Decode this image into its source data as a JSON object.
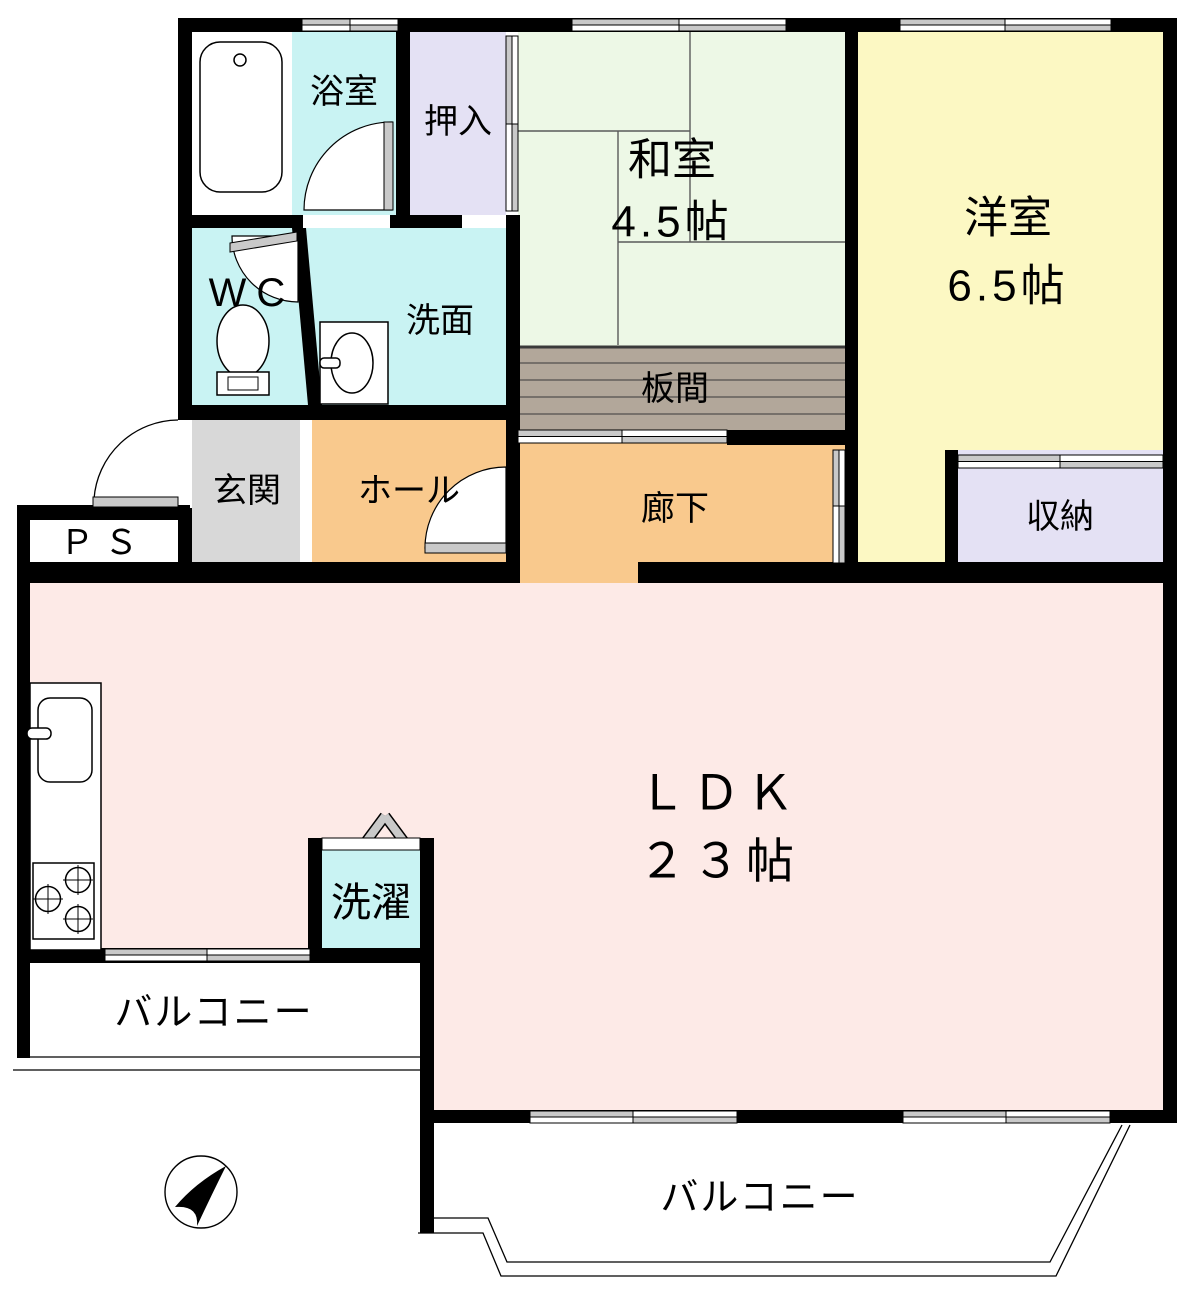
{
  "plan": {
    "type": "apartment-floor-plan",
    "rooms": {
      "bath": {
        "label": "浴室"
      },
      "oshiire": {
        "label": "押入"
      },
      "washitsu": {
        "label": "和室",
        "size": "4.5帖"
      },
      "youshitsu": {
        "label": "洋室",
        "size": "6.5帖"
      },
      "wc": {
        "label": "WC"
      },
      "senmen": {
        "label": "洗面"
      },
      "itama": {
        "label": "板間"
      },
      "genkan": {
        "label": "玄関"
      },
      "hall": {
        "label": "ホール"
      },
      "rouka": {
        "label": "廊下"
      },
      "shuno": {
        "label": "収納"
      },
      "ps": {
        "label": "ＰＳ"
      },
      "ldk": {
        "label": "ＬＤＫ",
        "size": "２３帖"
      },
      "sentaku": {
        "label": "洗濯"
      },
      "balcony_west": {
        "label": "バルコニー"
      },
      "balcony_south": {
        "label": "バルコニー"
      }
    },
    "colors": {
      "wall": "#000000",
      "wet_cyan": "#c9f3f3",
      "closet_lavender": "#e4e1f4",
      "tatami_green": "#edf8e6",
      "western_yellow": "#fcf8c3",
      "entry_gray": "#d8d8d8",
      "hall_orange": "#f9c98d",
      "ldk_pink": "#fdeae7",
      "itama_tan": "#b2a79a",
      "window_gray": "#c9c9c9",
      "background": "#ffffff"
    },
    "icons": [
      "bathtub-icon",
      "toilet-icon",
      "washbasin-icon",
      "kitchen-sink-icon",
      "stove-icon",
      "north-arrow-icon"
    ]
  }
}
